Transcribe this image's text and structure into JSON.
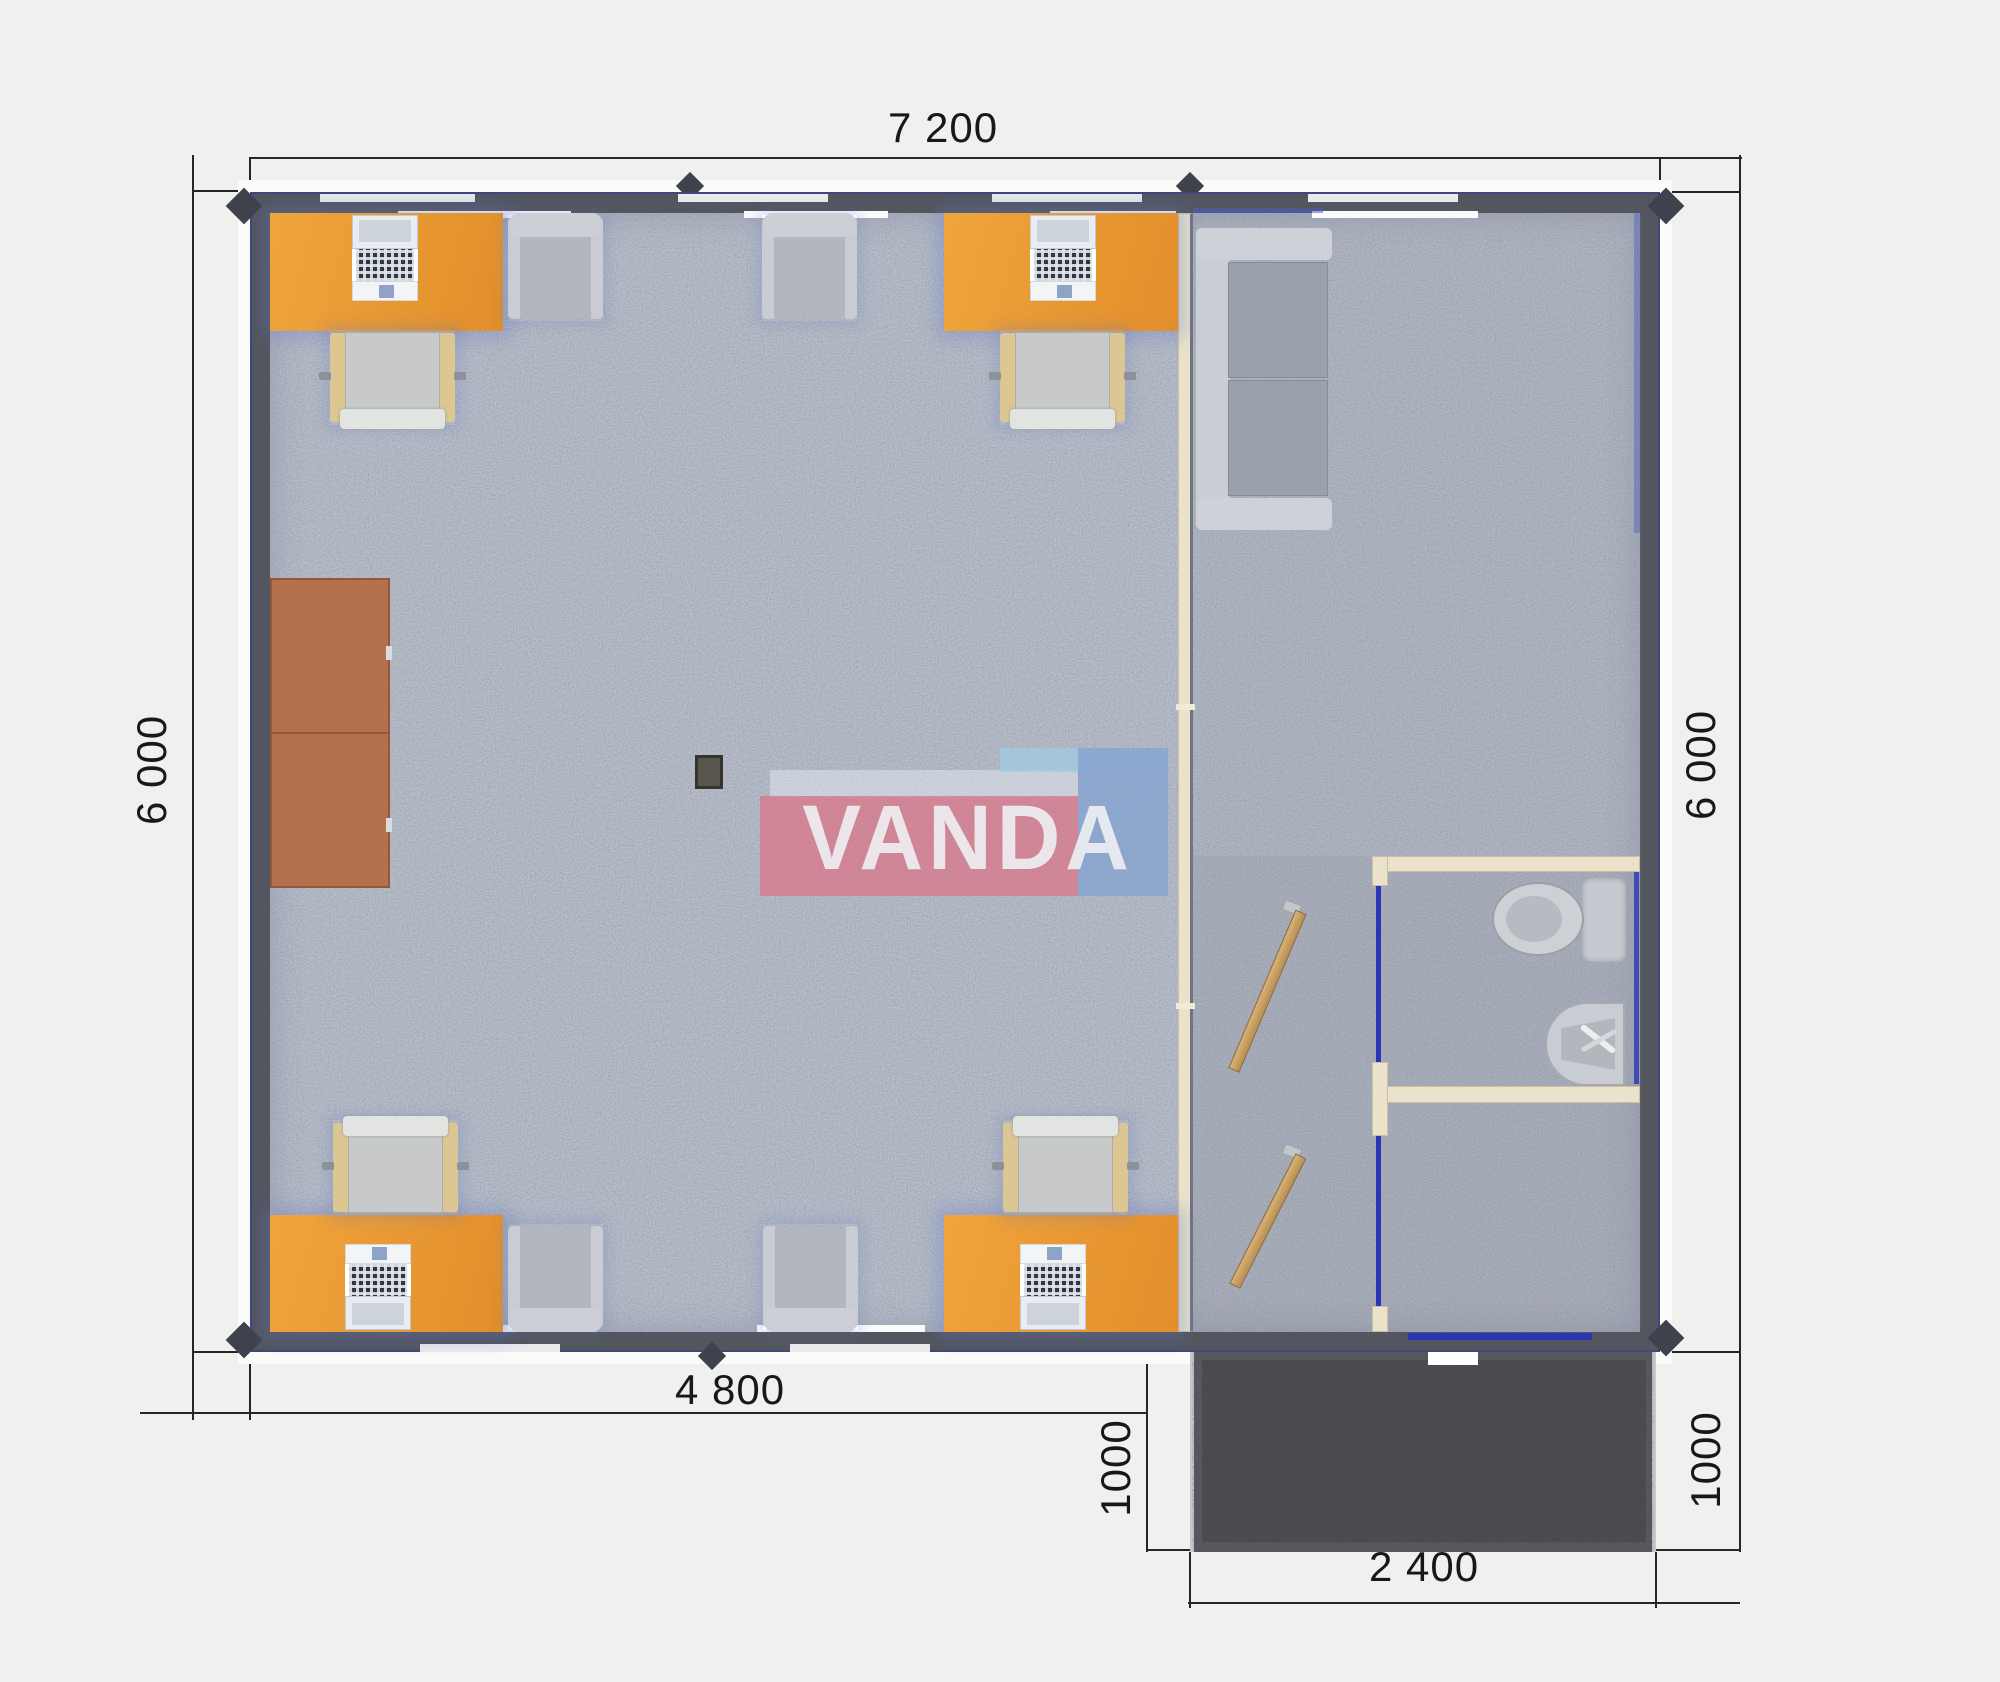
{
  "plan": {
    "brand": "VANDA",
    "dims": {
      "top": "7 200",
      "left": "6 000",
      "right": "6 000",
      "bottom_inner": "4 800",
      "porch_depth_left": "1000",
      "porch_depth_right": "1000",
      "porch_width": "2 400"
    },
    "palette": {
      "wall": "#53565e",
      "floor": "#bcc1cc",
      "desk_orange": "#e9973a",
      "partition_cream": "#eae2cb",
      "cabinet_sienna": "#b5714e",
      "door_frame_blue": "#2b36b4",
      "porch_dark": "#55575c",
      "logo_pink": "#de7082",
      "logo_blue": "#7ea0d2"
    },
    "furniture": [
      "desk",
      "desk",
      "desk",
      "desk",
      "desk-chair",
      "desk-chair",
      "desk-chair",
      "desk-chair",
      "armchair",
      "armchair",
      "armchair",
      "armchair",
      "sofa",
      "wardrobe-cabinet",
      "toilet",
      "sink",
      "floor-box",
      "open-door",
      "open-door"
    ]
  }
}
